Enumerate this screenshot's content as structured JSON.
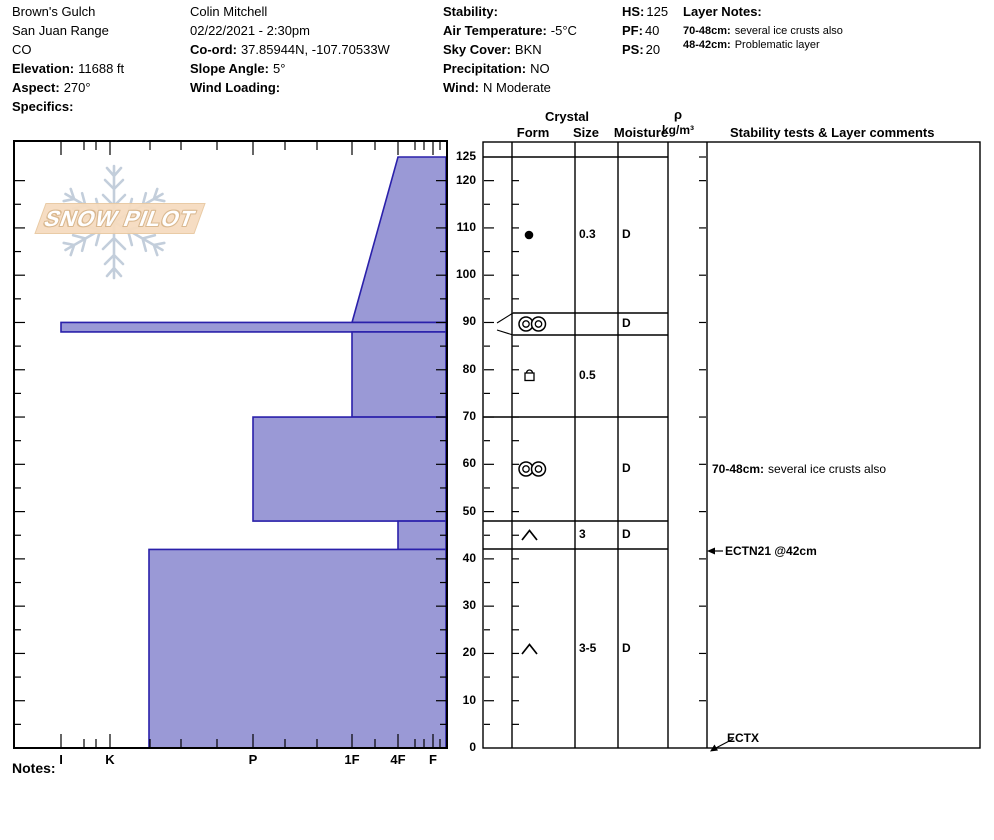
{
  "header": {
    "location": {
      "name": "Brown's Gulch",
      "range": "San Juan Range",
      "state": "CO",
      "elevation_label": "Elevation:",
      "elevation_value": "11688 ft",
      "aspect_label": "Aspect:",
      "aspect_value": "270°",
      "specifics_label": "Specifics:"
    },
    "observer": {
      "name": "Colin Mitchell",
      "datetime": "02/22/2021 - 2:30pm",
      "coord_label": "Co-ord:",
      "coord_value": "37.85944N, -107.70533W",
      "slope_label": "Slope Angle:",
      "slope_value": "5°",
      "wind_loading_label": "Wind Loading:",
      "wind_loading_value": ""
    },
    "conditions": {
      "stability_label": "Stability:",
      "stability_value": "",
      "air_temp_label": "Air Temperature:",
      "air_temp_value": "-5°C",
      "sky_label": "Sky Cover:",
      "sky_value": "BKN",
      "precip_label": "Precipitation:",
      "precip_value": "NO",
      "wind_label": "Wind:",
      "wind_value": "N Moderate"
    },
    "snowpack": {
      "hs_label": "HS:",
      "hs_value": "125",
      "pf_label": "PF:",
      "pf_value": "40",
      "ps_label": "PS:",
      "ps_value": "20"
    },
    "layer_notes": {
      "title": "Layer Notes:",
      "notes": [
        {
          "range": "70-48cm:",
          "text": "several ice crusts also"
        },
        {
          "range": "48-42cm:",
          "text": "Problematic layer"
        }
      ]
    }
  },
  "chart_data": {
    "type": "bar",
    "subtype": "snow-hardness-profile",
    "depth_unit": "cm",
    "total_depth": 125,
    "depth_tick_labels": [
      125,
      120,
      110,
      100,
      90,
      80,
      70,
      60,
      50,
      40,
      30,
      20,
      10,
      0
    ],
    "hardness_categories": [
      "I",
      "K",
      "P",
      "1F",
      "4F",
      "F"
    ],
    "layers": [
      {
        "top": 125,
        "bottom": 90,
        "hardness_top": "4F",
        "hardness_bottom": "1F",
        "form": "RG",
        "form_symbol": "dot",
        "size": "0.3",
        "moisture": "D"
      },
      {
        "top": 90,
        "bottom": 88,
        "hardness_top": "I",
        "hardness_bottom": "I",
        "form": "MFcr",
        "form_symbol": "double-crust",
        "size": "",
        "moisture": "D",
        "thin": true
      },
      {
        "top": 88,
        "bottom": 70,
        "hardness_top": "1F",
        "hardness_bottom": "1F",
        "form": "FC",
        "form_symbol": "square-crust",
        "size": "0.5",
        "moisture": ""
      },
      {
        "top": 70,
        "bottom": 48,
        "hardness_top": "P",
        "hardness_bottom": "P",
        "form": "MFcr",
        "form_symbol": "double-crust",
        "size": "",
        "moisture": "D"
      },
      {
        "top": 48,
        "bottom": 42,
        "hardness_top": "4F",
        "hardness_bottom": "4F",
        "form": "DH",
        "form_symbol": "caret",
        "size": "3",
        "moisture": "D"
      },
      {
        "top": 42,
        "bottom": 0,
        "hardness_top": "K-",
        "hardness_bottom": "K-",
        "form": "DH",
        "form_symbol": "caret",
        "size": "3-5",
        "moisture": "D"
      }
    ]
  },
  "table": {
    "headers": {
      "crystal": "Crystal",
      "form": "Form",
      "size": "Size",
      "moisture": "Moisture",
      "rho": "ρ",
      "rho_unit": "kg/m³",
      "comments": "Stability tests & Layer comments"
    }
  },
  "annotations": {
    "layer_comment": {
      "prefix": "70-48cm:",
      "text": "several ice crusts also"
    },
    "ect_mid": "ECTN21 @42cm",
    "ect_bottom": "ECTX"
  },
  "notes_label": "Notes:",
  "logo": {
    "text": "SNOW PILOT"
  },
  "colors": {
    "layer_fill": "#9a99d6",
    "layer_border": "#2a20aa",
    "snowflake": "#c3cedb",
    "banner": "#f6dcc0"
  }
}
